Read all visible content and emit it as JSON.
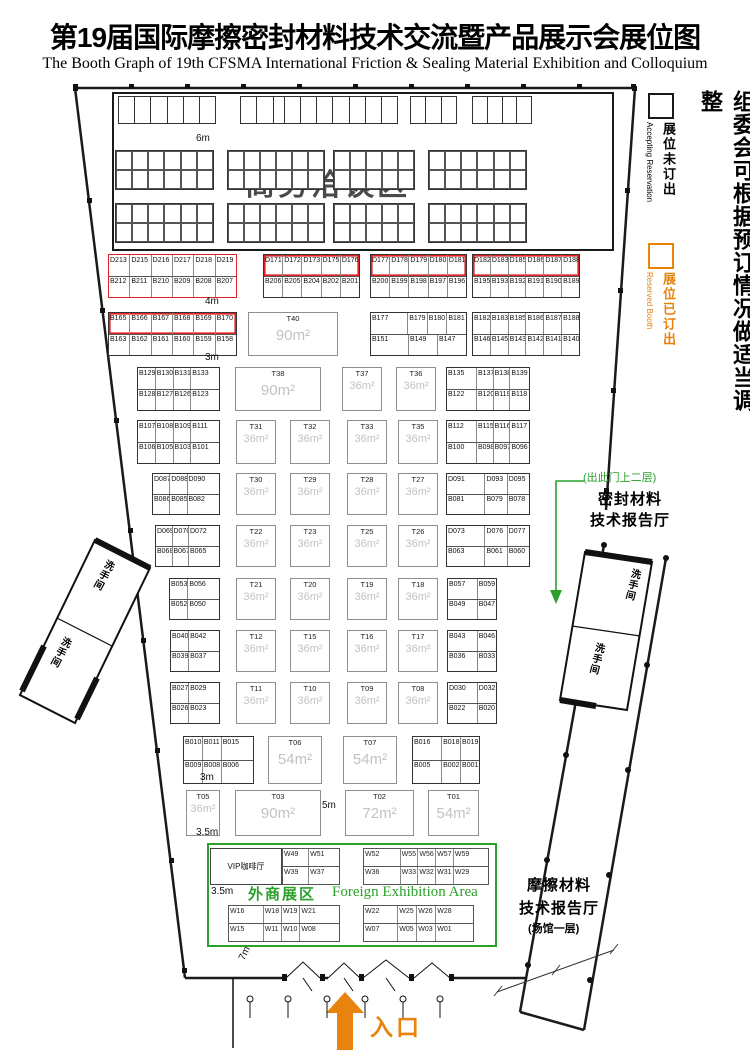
{
  "title": {
    "zh": "第19届国际摩擦密封材料技术交流暨产品展示会展位图",
    "en": "The Booth Graph of 19th CFSMA International Friction & Sealing Material Exhibition and Colloquium"
  },
  "legend": {
    "note_vertical": "组委会可根据预订情况做适当调整",
    "accepting": {
      "zh": "展位未订出",
      "en": "Accepting Reservation",
      "box_color": "#1a1a1a"
    },
    "reserved": {
      "zh": "展位已订出",
      "en": "Reserved Booth",
      "box_color": "#e8840e"
    }
  },
  "colors": {
    "reserved_orange": "#e8840e",
    "highlight_red": "#e02222",
    "green": "#2ba02b",
    "area_text_gray": "#c2c2c2"
  },
  "negotiation_area": {
    "label": "商务洽谈区",
    "strips": [
      {
        "x": 118,
        "w": 96,
        "n": 6
      },
      {
        "x": 240,
        "w": 48,
        "n": 3
      },
      {
        "x": 284,
        "w": 112,
        "n": 7
      },
      {
        "x": 410,
        "w": 45,
        "n": 3
      },
      {
        "x": 472,
        "w": 58,
        "n": 4
      }
    ],
    "blocks": [
      {
        "x": 115,
        "y": 150,
        "w": 97,
        "cols": 6
      },
      {
        "x": 227,
        "y": 150,
        "w": 96,
        "cols": 6
      },
      {
        "x": 333,
        "y": 150,
        "w": 80,
        "cols": 5
      },
      {
        "x": 428,
        "y": 150,
        "w": 97,
        "cols": 6
      },
      {
        "x": 115,
        "y": 203,
        "w": 97,
        "cols": 6
      },
      {
        "x": 227,
        "y": 203,
        "w": 96,
        "cols": 6
      },
      {
        "x": 333,
        "y": 203,
        "w": 80,
        "cols": 5
      },
      {
        "x": 428,
        "y": 203,
        "w": 97,
        "cols": 6
      }
    ]
  },
  "booth_blocks": [
    {
      "x": 108,
      "y": 254,
      "w": 127,
      "h": 42,
      "style": "red",
      "rows": [
        [
          "D213",
          "D215",
          "D216",
          "D217",
          "D218",
          "D219"
        ],
        [
          "B212",
          "B211",
          "B210",
          "B209",
          "B208",
          "B207"
        ]
      ]
    },
    {
      "x": 263,
      "y": 254,
      "w": 95,
      "h": 42,
      "style": "redtop",
      "rows": [
        [
          "D171",
          "D172",
          "D173",
          "D175",
          "D176"
        ],
        [
          "B206",
          "B205",
          "B204",
          "B202",
          "B201"
        ]
      ]
    },
    {
      "x": 370,
      "y": 254,
      "w": 95,
      "h": 42,
      "style": "redtop",
      "rows": [
        [
          "D177",
          "D178",
          "D179",
          "D180",
          "D181"
        ],
        [
          "B200",
          "B199",
          "B198",
          "B197",
          "B196"
        ]
      ]
    },
    {
      "x": 472,
      "y": 254,
      "w": 106,
      "h": 42,
      "style": "redtop",
      "rows": [
        [
          "D182",
          "D183",
          "D185",
          "D186",
          "D187",
          "D188"
        ],
        [
          "B195",
          "B193",
          "B192",
          "B191",
          "B190",
          "B189"
        ]
      ]
    },
    {
      "x": 108,
      "y": 312,
      "w": 127,
      "h": 42,
      "style": "redtop",
      "rows": [
        [
          "B165",
          "B166",
          "B167",
          "B168",
          "B169",
          "B170"
        ],
        [
          "B163",
          "B162",
          "B161",
          "B160",
          "B159",
          "B158"
        ]
      ]
    },
    {
      "x": 370,
      "y": 312,
      "w": 95,
      "h": 42,
      "style": "plain",
      "rows": [
        [
          "B177|2",
          "B179",
          "B180",
          "B181"
        ],
        [
          "B151|2",
          "B149|1.5",
          "B147|1.5"
        ]
      ]
    },
    {
      "x": 472,
      "y": 312,
      "w": 106,
      "h": 42,
      "style": "plain",
      "rows": [
        [
          "B182",
          "B183",
          "B185",
          "B186",
          "B187",
          "B188"
        ],
        [
          "B146",
          "B145",
          "B143",
          "B142",
          "B141",
          "B140"
        ]
      ]
    },
    {
      "x": 137,
      "y": 367,
      "w": 81,
      "h": 42,
      "style": "plain",
      "rows": [
        [
          "B129",
          "B130",
          "B131",
          "B133|1.7"
        ],
        [
          "B128",
          "B127",
          "B126",
          "B123|1.7"
        ]
      ]
    },
    {
      "x": 446,
      "y": 367,
      "w": 82,
      "h": 42,
      "style": "plain",
      "rows": [
        [
          "B135|1.9",
          "B137",
          "B138",
          "B139|1.2"
        ],
        [
          "B122|1.9",
          "B120",
          "B119",
          "B118|1.2"
        ]
      ]
    },
    {
      "x": 137,
      "y": 420,
      "w": 81,
      "h": 42,
      "style": "plain",
      "rows": [
        [
          "B107",
          "B108",
          "B109",
          "B111|1.7"
        ],
        [
          "B106",
          "B105",
          "B103",
          "B101|1.7"
        ]
      ]
    },
    {
      "x": 446,
      "y": 420,
      "w": 82,
      "h": 42,
      "style": "plain",
      "rows": [
        [
          "B112|1.9",
          "B115",
          "B116",
          "B117|1.2"
        ],
        [
          "B100|1.9",
          "B098",
          "B097",
          "B096|1.2"
        ]
      ]
    },
    {
      "x": 152,
      "y": 473,
      "w": 66,
      "h": 40,
      "style": "plain",
      "rows": [
        [
          "D087",
          "D088",
          "D090|2"
        ],
        [
          "B086",
          "B085",
          "B082|2"
        ]
      ]
    },
    {
      "x": 446,
      "y": 473,
      "w": 82,
      "h": 40,
      "style": "plain",
      "rows": [
        [
          "D091|1.8",
          "D093",
          "D095"
        ],
        [
          "B081|1.8",
          "B079",
          "B078"
        ]
      ]
    },
    {
      "x": 155,
      "y": 525,
      "w": 63,
      "h": 40,
      "style": "plain",
      "rows": [
        [
          "D069",
          "D070",
          "D072|2"
        ],
        [
          "B068",
          "B067",
          "B065|2"
        ]
      ]
    },
    {
      "x": 446,
      "y": 525,
      "w": 82,
      "h": 40,
      "style": "plain",
      "rows": [
        [
          "D073|1.8",
          "D076",
          "D077"
        ],
        [
          "B063|1.8",
          "B061",
          "B060"
        ]
      ]
    },
    {
      "x": 169,
      "y": 578,
      "w": 49,
      "h": 40,
      "style": "plain",
      "rows": [
        [
          "B053",
          "B056|1.8"
        ],
        [
          "B052",
          "B050|1.8"
        ]
      ]
    },
    {
      "x": 447,
      "y": 578,
      "w": 48,
      "h": 40,
      "style": "plain",
      "rows": [
        [
          "B057|1.6",
          "B059"
        ],
        [
          "B049|1.6",
          "B047"
        ]
      ]
    },
    {
      "x": 170,
      "y": 630,
      "w": 48,
      "h": 40,
      "style": "plain",
      "rows": [
        [
          "B040",
          "B042|1.8"
        ],
        [
          "B039",
          "B037|1.8"
        ]
      ]
    },
    {
      "x": 447,
      "y": 630,
      "w": 48,
      "h": 40,
      "style": "plain",
      "rows": [
        [
          "B043|1.6",
          "B046"
        ],
        [
          "B036|1.6",
          "B033"
        ]
      ]
    },
    {
      "x": 170,
      "y": 682,
      "w": 48,
      "h": 40,
      "style": "plain",
      "rows": [
        [
          "B027",
          "B029|1.8"
        ],
        [
          "B026",
          "B023|1.8"
        ]
      ]
    },
    {
      "x": 447,
      "y": 682,
      "w": 48,
      "h": 40,
      "style": "plain",
      "rows": [
        [
          "D030|1.6",
          "D032"
        ],
        [
          "B022|1.6",
          "B020"
        ]
      ]
    },
    {
      "x": 183,
      "y": 736,
      "w": 69,
      "h": 46,
      "style": "plain",
      "rows": [
        [
          "B010",
          "B011",
          "B015|1.8"
        ],
        [
          "B009",
          "B008",
          "B006|1.8"
        ]
      ]
    },
    {
      "x": 412,
      "y": 736,
      "w": 66,
      "h": 46,
      "style": "plain",
      "rows": [
        [
          "B016|1.6",
          "B018",
          "B019"
        ],
        [
          "B005|1.6",
          "B002",
          "B001"
        ]
      ]
    }
  ],
  "t_booths": [
    {
      "id": "T40",
      "area": "90m²",
      "x": 248,
      "y": 312,
      "w": 88,
      "h": 42,
      "big": true
    },
    {
      "id": "T38",
      "area": "90m²",
      "x": 235,
      "y": 367,
      "w": 84,
      "h": 42,
      "big": true
    },
    {
      "id": "T37",
      "area": "36m²",
      "x": 342,
      "y": 367,
      "w": 38,
      "h": 42
    },
    {
      "id": "T36",
      "area": "36m²",
      "x": 396,
      "y": 367,
      "w": 38,
      "h": 42
    },
    {
      "id": "T31",
      "area": "36m²",
      "x": 236,
      "y": 420,
      "w": 38,
      "h": 42
    },
    {
      "id": "T32",
      "area": "36m²",
      "x": 290,
      "y": 420,
      "w": 38,
      "h": 42
    },
    {
      "id": "T33",
      "area": "36m²",
      "x": 347,
      "y": 420,
      "w": 38,
      "h": 42
    },
    {
      "id": "T35",
      "area": "36m²",
      "x": 398,
      "y": 420,
      "w": 38,
      "h": 42
    },
    {
      "id": "T30",
      "area": "36m²",
      "x": 236,
      "y": 473,
      "w": 38,
      "h": 40
    },
    {
      "id": "T29",
      "area": "36m²",
      "x": 290,
      "y": 473,
      "w": 38,
      "h": 40
    },
    {
      "id": "T28",
      "area": "36m²",
      "x": 347,
      "y": 473,
      "w": 38,
      "h": 40
    },
    {
      "id": "T27",
      "area": "36m²",
      "x": 398,
      "y": 473,
      "w": 38,
      "h": 40
    },
    {
      "id": "T22",
      "area": "36m²",
      "x": 236,
      "y": 525,
      "w": 38,
      "h": 40
    },
    {
      "id": "T23",
      "area": "36m²",
      "x": 290,
      "y": 525,
      "w": 38,
      "h": 40
    },
    {
      "id": "T25",
      "area": "36m²",
      "x": 347,
      "y": 525,
      "w": 38,
      "h": 40
    },
    {
      "id": "T26",
      "area": "36m²",
      "x": 398,
      "y": 525,
      "w": 38,
      "h": 40
    },
    {
      "id": "T21",
      "area": "36m²",
      "x": 236,
      "y": 578,
      "w": 38,
      "h": 40
    },
    {
      "id": "T20",
      "area": "36m²",
      "x": 290,
      "y": 578,
      "w": 38,
      "h": 40
    },
    {
      "id": "T19",
      "area": "36m²",
      "x": 347,
      "y": 578,
      "w": 38,
      "h": 40
    },
    {
      "id": "T18",
      "area": "36m²",
      "x": 398,
      "y": 578,
      "w": 38,
      "h": 40
    },
    {
      "id": "T12",
      "area": "36m²",
      "x": 236,
      "y": 630,
      "w": 38,
      "h": 40
    },
    {
      "id": "T15",
      "area": "36m²",
      "x": 290,
      "y": 630,
      "w": 38,
      "h": 40
    },
    {
      "id": "T16",
      "area": "36m²",
      "x": 347,
      "y": 630,
      "w": 38,
      "h": 40
    },
    {
      "id": "T17",
      "area": "36m²",
      "x": 398,
      "y": 630,
      "w": 38,
      "h": 40
    },
    {
      "id": "T11",
      "area": "36m²",
      "x": 236,
      "y": 682,
      "w": 38,
      "h": 40
    },
    {
      "id": "T10",
      "area": "36m²",
      "x": 290,
      "y": 682,
      "w": 38,
      "h": 40
    },
    {
      "id": "T09",
      "area": "36m²",
      "x": 347,
      "y": 682,
      "w": 38,
      "h": 40
    },
    {
      "id": "T08",
      "area": "36m²",
      "x": 398,
      "y": 682,
      "w": 38,
      "h": 40
    },
    {
      "id": "T06",
      "area": "54m²",
      "x": 268,
      "y": 736,
      "w": 52,
      "h": 46,
      "big": true
    },
    {
      "id": "T07",
      "area": "54m²",
      "x": 343,
      "y": 736,
      "w": 52,
      "h": 46,
      "big": true
    },
    {
      "id": "T05",
      "area": "36m²",
      "x": 186,
      "y": 790,
      "w": 32,
      "h": 44
    },
    {
      "id": "T03",
      "area": "90m²",
      "x": 235,
      "y": 790,
      "w": 84,
      "h": 44,
      "big": true
    },
    {
      "id": "T02",
      "area": "72m²",
      "x": 345,
      "y": 790,
      "w": 67,
      "h": 44,
      "big": true
    },
    {
      "id": "T01",
      "area": "54m²",
      "x": 428,
      "y": 790,
      "w": 49,
      "h": 44,
      "big": true
    }
  ],
  "foreign_area": {
    "zh": "外商展区",
    "en": "Foreign Exhibition Area",
    "vip_label": "VIP咖啡厅",
    "blocks": [
      {
        "x": 282,
        "y": 848,
        "w": 56,
        "h": 35,
        "rows": [
          [
            "W49",
            "W51|1.2"
          ],
          [
            "W39",
            "W37|1.2"
          ]
        ]
      },
      {
        "x": 363,
        "y": 848,
        "w": 124,
        "h": 35,
        "rows": [
          [
            "W52|2.2",
            "W55",
            "W56",
            "W57",
            "W59|2.1"
          ],
          [
            "W36|2.2",
            "W33",
            "W32",
            "W31",
            "W29|2.1"
          ]
        ]
      },
      {
        "x": 228,
        "y": 905,
        "w": 110,
        "h": 35,
        "rows": [
          [
            "W16|2",
            "W18",
            "W19",
            "W21|2.3"
          ],
          [
            "W15|2",
            "W11",
            "W10",
            "W08|2.3"
          ]
        ]
      },
      {
        "x": 363,
        "y": 905,
        "w": 109,
        "h": 35,
        "rows": [
          [
            "W22|1.9",
            "W25",
            "W26",
            "W28|2.1"
          ],
          [
            "W07|1.9",
            "W05",
            "W03",
            "W01|2.1"
          ]
        ]
      }
    ]
  },
  "halls": {
    "sealing_note": "(出此门上二层)",
    "sealing_lines": [
      "密封材料",
      "技术报告厅"
    ],
    "friction_lines": [
      "摩擦材料",
      "技术报告厅",
      "(场馆一层)"
    ]
  },
  "restroom_label": "洗手间",
  "entrance_label": "入口",
  "dim_labels": [
    {
      "t": "6m",
      "x": 196,
      "y": 133
    },
    {
      "t": "4m",
      "x": 205,
      "y": 296
    },
    {
      "t": "3m",
      "x": 205,
      "y": 352
    },
    {
      "t": "3m",
      "x": 200,
      "y": 772
    },
    {
      "t": "3.5m",
      "x": 196,
      "y": 827
    },
    {
      "t": "5m",
      "x": 322,
      "y": 800
    },
    {
      "t": "3.5m",
      "x": 211,
      "y": 886
    },
    {
      "t": "7m",
      "x": 238,
      "y": 948,
      "rot": -65
    }
  ]
}
